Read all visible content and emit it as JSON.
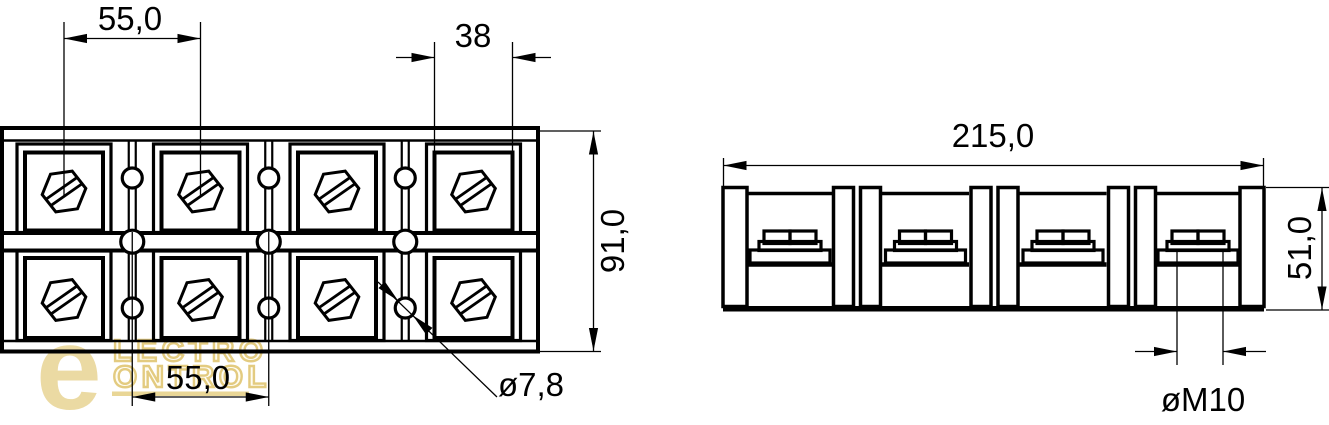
{
  "dims": {
    "pitch_top": "55,0",
    "opening": "38",
    "height": "91,0",
    "pitch_bottom": "55,0",
    "hole": "ø7,8",
    "length": "215,0",
    "side_height": "51,0",
    "thread": "øM10"
  },
  "watermark": {
    "letter": "e",
    "line1": "LECTRO",
    "line2": "ONTROL",
    "color": "#e8d494",
    "outline": "#dfc26a",
    "fill": "#fffdf2",
    "underline_color": "#e6cf84"
  }
}
